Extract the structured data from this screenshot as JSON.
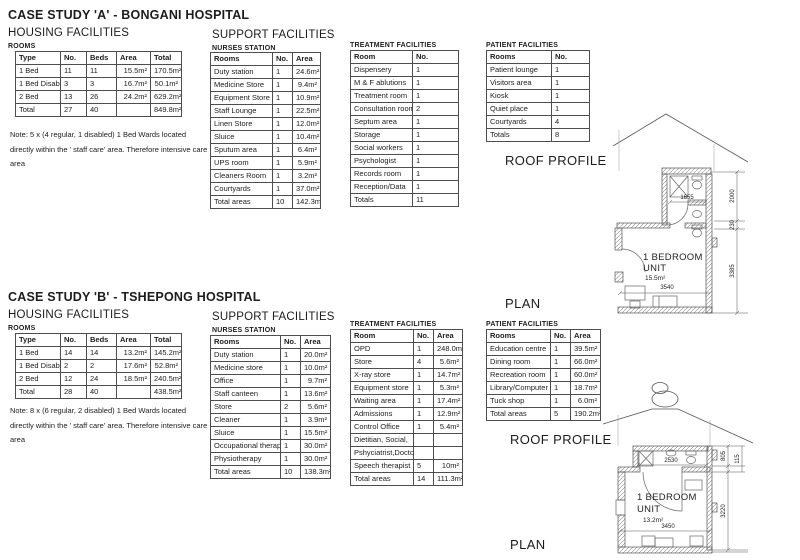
{
  "case_a": {
    "title": "CASE STUDY 'A' - BONGANI HOSPITAL",
    "housing": {
      "section_title": "HOUSING FACILITIES",
      "label": "ROOMS",
      "headers": [
        "Type",
        "No.",
        "Beds",
        "Area",
        "Total"
      ],
      "rows": [
        [
          "1 Bed",
          "11",
          "11",
          "15.5m²",
          "170.5m²"
        ],
        [
          "1 Bed Disabled",
          "3",
          "3",
          "16.7m²",
          "50.1m²"
        ],
        [
          "2 Bed",
          "13",
          "26",
          "24.2m²",
          "629.2m²"
        ],
        [
          "Total",
          "27",
          "40",
          "",
          "849.8m²"
        ]
      ],
      "note_lines": [
        "Note: 5 x (4 regular, 1 disabled) 1 Bed Wards located",
        "directly within the ' staff care' area. Therefore intensive care",
        "area"
      ]
    },
    "support": {
      "section_title": "SUPPORT FACILITIES",
      "label": "NURSES STATION",
      "headers": [
        "Rooms",
        "No.",
        "Area"
      ],
      "rows": [
        [
          "Duty station",
          "1",
          "24.6m²"
        ],
        [
          "Medicine Store",
          "1",
          "9.4m²"
        ],
        [
          "Equipment Store",
          "1",
          "10.9m²"
        ],
        [
          "Staff Lounge",
          "1",
          "22.5m²"
        ],
        [
          "Linen Store",
          "1",
          "12.0m²"
        ],
        [
          "Sluice",
          "1",
          "10.4m²"
        ],
        [
          "Sputum area",
          "1",
          "6.4m²"
        ],
        [
          "UPS room",
          "1",
          "5.9m²"
        ],
        [
          "Cleaners Room",
          "1",
          "3.2m²"
        ],
        [
          "Courtyards",
          "1",
          "37.0m²"
        ],
        [
          "Total areas",
          "10",
          "142.3m²"
        ]
      ]
    },
    "treatment": {
      "label": "TREATMENT FACILITIES",
      "headers": [
        "Room",
        "No."
      ],
      "rows": [
        [
          "Dispensery",
          "1"
        ],
        [
          "M & F ablutions",
          "1"
        ],
        [
          "Treatment room",
          "1"
        ],
        [
          "Consultation room",
          "2"
        ],
        [
          "Septum area",
          "1"
        ],
        [
          "Storage",
          "1"
        ],
        [
          "Social workers",
          "1"
        ],
        [
          "Psychologist",
          "1"
        ],
        [
          "Records room",
          "1"
        ],
        [
          "Reception/Data",
          "1"
        ],
        [
          "Totals",
          "11"
        ]
      ]
    },
    "patient": {
      "label": "PATIENT FACILITIES",
      "headers": [
        "Rooms",
        "No."
      ],
      "rows": [
        [
          "Patient lounge",
          "1"
        ],
        [
          "Visitors area",
          "1"
        ],
        [
          "Kiosk",
          "1"
        ],
        [
          "Quiet place",
          "1"
        ],
        [
          "Courtyards",
          "4"
        ],
        [
          "Totals",
          "8"
        ]
      ]
    },
    "drawing": {
      "roof_label": "ROOF PROFILE",
      "plan_label": "PLAN",
      "unit_line1": "1 BEDROOM",
      "unit_line2": "UNIT",
      "unit_area": "15.5m²",
      "dims": {
        "bath_width": "1655",
        "room_width": "3540",
        "h1": "2000",
        "h2": "230",
        "h3": "3385"
      }
    }
  },
  "case_b": {
    "title": "CASE STUDY 'B' - TSHEPONG HOSPITAL",
    "housing": {
      "section_title": "HOUSING FACILITIES",
      "label": "ROOMS",
      "headers": [
        "Type",
        "No.",
        "Beds",
        "Area",
        "Total"
      ],
      "rows": [
        [
          "1 Bed",
          "14",
          "14",
          "13.2m²",
          "145.2m²"
        ],
        [
          "1 Bed Disabled",
          "2",
          "2",
          "17.6m²",
          "52.8m²"
        ],
        [
          "2 Bed",
          "12",
          "24",
          "18.5m²",
          "240.5m²"
        ],
        [
          "Total",
          "28",
          "40",
          "",
          "438.5m²"
        ]
      ],
      "note_lines": [
        "Note: 8 x (6 regular, 2 disabled) 1 Bed Wards located",
        "directly within the ' staff care' area. Therefore intensive care",
        "area"
      ]
    },
    "support": {
      "section_title": "SUPPORT FACILITIES",
      "label": "NURSES STATION",
      "headers": [
        "Rooms",
        "No.",
        "Area"
      ],
      "rows": [
        [
          "Duty station",
          "1",
          "20.0m²"
        ],
        [
          "Medicine store",
          "1",
          "10.0m²"
        ],
        [
          "Office",
          "1",
          "9.7m²"
        ],
        [
          "Staff canteen",
          "1",
          "13.6m²"
        ],
        [
          "Store",
          "2",
          "5.6m²"
        ],
        [
          "Cleaner",
          "1",
          "3.9m²"
        ],
        [
          "Sluice",
          "1",
          "15.5m²"
        ],
        [
          "Occupational therapy",
          "1",
          "30.0m²"
        ],
        [
          "Physiotherapy",
          "1",
          "30.0m²"
        ],
        [
          "Total areas",
          "10",
          "138.3m²"
        ]
      ]
    },
    "treatment": {
      "label": "TREATMENT FACILITIES",
      "headers": [
        "Room",
        "No.",
        "Area"
      ],
      "rows": [
        [
          "OPD",
          "1",
          "248.0m²"
        ],
        [
          "Store",
          "4",
          "5.6m²"
        ],
        [
          "X-ray store",
          "1",
          "14.7m²"
        ],
        [
          "Equipment store",
          "1",
          "5.3m²"
        ],
        [
          "Waiting area",
          "1",
          "17.4m²"
        ],
        [
          "Admissions",
          "1",
          "12.9m²"
        ],
        [
          "Control Office",
          "1",
          "5.4m²"
        ],
        [
          "Dietitian, Social,",
          "",
          ""
        ],
        [
          "Pshyciatrist,Doctor,",
          "",
          ""
        ],
        [
          "Speech therapist",
          "5",
          "10m²"
        ],
        [
          "Total areas",
          "14",
          "111.3m²"
        ]
      ]
    },
    "patient": {
      "label": "PATIENT FACILITIES",
      "headers": [
        "Rooms",
        "No.",
        "Area"
      ],
      "rows": [
        [
          "Education centre",
          "1",
          "39.5m²"
        ],
        [
          "Dining room",
          "1",
          "66.0m²"
        ],
        [
          "Recreation room",
          "1",
          "60.0m²"
        ],
        [
          "Library/Computer",
          "1",
          "18.7m²"
        ],
        [
          "Tuck shop",
          "1",
          "6.0m²"
        ],
        [
          "Total areas",
          "5",
          "190.2m²"
        ]
      ]
    },
    "drawing": {
      "roof_label": "ROOF PROFILE",
      "plan_label": "PLAN",
      "unit_line1": "1 BEDROOM",
      "unit_line2": "UNIT",
      "unit_area": "13.2m²",
      "dims": {
        "bath_width": "2530",
        "room_width": "3450",
        "h1": "805",
        "h2": "115",
        "h3": "3220"
      }
    }
  }
}
